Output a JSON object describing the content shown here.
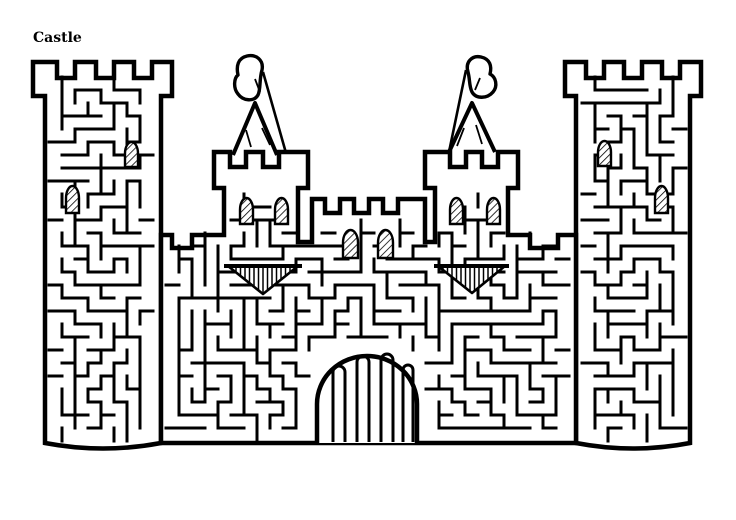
{
  "title": "Castle",
  "figure": {
    "kind": "maze-puzzle",
    "subject": "castle",
    "ink": "#000000",
    "paper": "#ffffff",
    "canvas": {
      "width": 736,
      "height": 520
    },
    "outline_width": 4.5,
    "maze": {
      "seed": 29,
      "cell": 13,
      "origin": [
        36,
        64
      ],
      "cols": 51,
      "rows": 30,
      "wall_width": 3,
      "regions": [
        [
          37,
          79,
          131,
          14
        ],
        [
          49,
          93,
          108,
          348
        ],
        [
          569,
          79,
          128,
          14
        ],
        [
          580,
          93,
          106,
          348
        ],
        [
          164,
          239,
          408,
          203
        ],
        [
          218,
          168,
          86,
          19
        ],
        [
          228,
          188,
          66,
          53
        ],
        [
          429,
          168,
          85,
          19
        ],
        [
          439,
          188,
          65,
          53
        ],
        [
          318,
          214,
          103,
          27
        ]
      ],
      "holes": [
        [
          310,
          346,
          115,
          102
        ]
      ]
    },
    "silhouettes": [
      {
        "name": "left-tower",
        "d": "M45 443 L45 96 L33 96 L33 62 L57 62 L57 78 L75 78 L75 62 L96 62 L96 78 L114 78 L114 62 L134 62 L134 78 L152 78 L152 62 L172 62 L172 96 L161 96 L161 443 Q103 454 45 443 Z"
      },
      {
        "name": "right-tower",
        "d": "M576 443 L576 96 L565 96 L565 62 L586 62 L586 78 L604 78 L604 62 L624 62 L624 78 L642 78 L642 62 L662 62 L662 78 L680 78 L680 62 L701 62 L701 96 L690 96 L690 443 Q633 454 576 443 Z"
      },
      {
        "name": "curtain-wall-and-keep",
        "d": "M161 235 L172 235 L172 248 L192 248 L192 235 L224 235 L224 188 L214 188 L214 152 L230 152 L230 167 L246 167 L246 152 L263 152 L263 167 L279 167 L279 152 L308 152 L308 188 L298 188 L298 242 L312 242 L312 199 L325 199 L325 213 L340 213 L340 199 L354 199 L354 213 L369 213 L369 199 L383 199 L383 213 L398 213 L398 199 L425 199 L425 242 L435 242 L435 188 L425 188 L425 152 L450 152 L450 167 L466 167 L466 152 L482 152 L482 167 L498 167 L498 152 L518 152 L518 188 L508 188 L508 235 L530 235 L530 248 L558 248 L558 235 L576 235 L576 443 L161 443 Z"
      }
    ],
    "cones": [
      {
        "name": "left-turret-roof",
        "d": "M233 155 L255 103 L277 155",
        "inner": [
          [
            246,
            130,
            251,
            147
          ],
          [
            262,
            128,
            270,
            145
          ]
        ]
      },
      {
        "name": "right-turret-roof",
        "d": "M449 152 L472 103 L495 152",
        "inner": [
          [
            464,
            128,
            457,
            146
          ],
          [
            476,
            125,
            482,
            144
          ]
        ]
      }
    ],
    "flags": [
      {
        "name": "left-flag",
        "pole": [
          263,
          72,
          286,
          153
        ],
        "d": "M262 70 C264 60 256 54 247 56 C238 58 236 66 238 75 C234 78 233 88 238 94 C243 101 254 102 258 95 C261 89 259 80 262 70 Z",
        "mark": [
          255,
          79,
          260,
          92
        ]
      },
      {
        "name": "right-flag",
        "pole": [
          466,
          70,
          449,
          152
        ],
        "d": "M468 72 C465 62 472 55 481 57 C490 59 492 66 490 74 C496 77 498 86 493 92 C487 99 476 99 472 92 C469 86 470 79 468 72 Z",
        "mark": [
          480,
          78,
          475,
          90
        ]
      }
    ],
    "windows": [
      [
        125,
        142,
        13,
        25
      ],
      [
        66,
        186,
        13,
        27
      ],
      [
        598,
        141,
        13,
        25
      ],
      [
        655,
        186,
        13,
        27
      ],
      [
        240,
        198,
        13,
        26
      ],
      [
        275,
        198,
        13,
        26
      ],
      [
        450,
        198,
        13,
        26
      ],
      [
        487,
        198,
        13,
        26
      ],
      [
        343,
        230,
        15,
        28
      ],
      [
        378,
        230,
        15,
        28
      ]
    ],
    "triangles": [
      [
        228,
        266,
        298,
        266,
        263,
        294
      ],
      [
        438,
        266,
        505,
        266,
        472,
        293
      ]
    ],
    "gate": {
      "dome": "M317 443 L317 404 A50 48 0 0 1 417 404 L417 443",
      "bars": [
        [
          333,
          345,
          372
        ],
        [
          357,
          369,
          362
        ],
        [
          381,
          393,
          360
        ],
        [
          403,
          413,
          370
        ]
      ],
      "bar_width": 3
    }
  }
}
